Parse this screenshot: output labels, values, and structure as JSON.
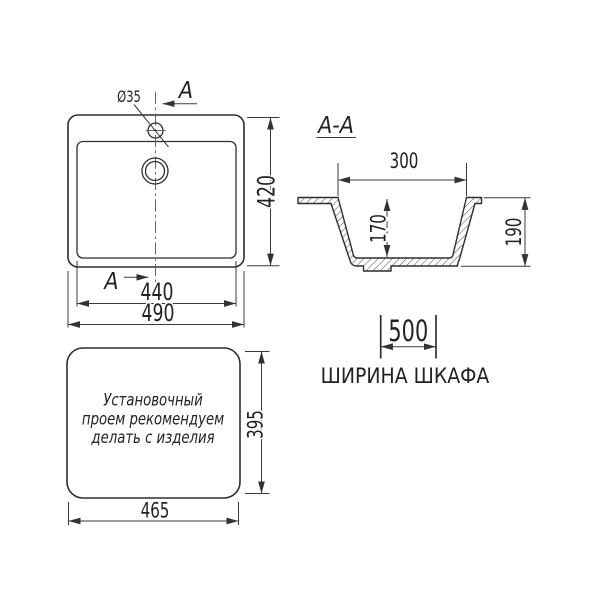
{
  "colors": {
    "background": "#ffffff",
    "line": "#2e2e2e",
    "text": "#222222"
  },
  "top_view": {
    "hole_label": "Ø35",
    "section_arrow_top": "A",
    "section_arrow_bottom": "A",
    "inner_width": "440",
    "outer_width": "490",
    "outer_depth": "420"
  },
  "section_view": {
    "title": "A-A",
    "top_width": "300",
    "bowl_depth": "170",
    "overall_depth": "190"
  },
  "cabinet": {
    "width": "500",
    "caption": "ШИРИНА ШКАФА"
  },
  "cutout_view": {
    "note_line1": "Установочный",
    "note_line2": "проем рекомендуем",
    "note_line3": "делать с изделия",
    "width": "465",
    "height": "395"
  }
}
